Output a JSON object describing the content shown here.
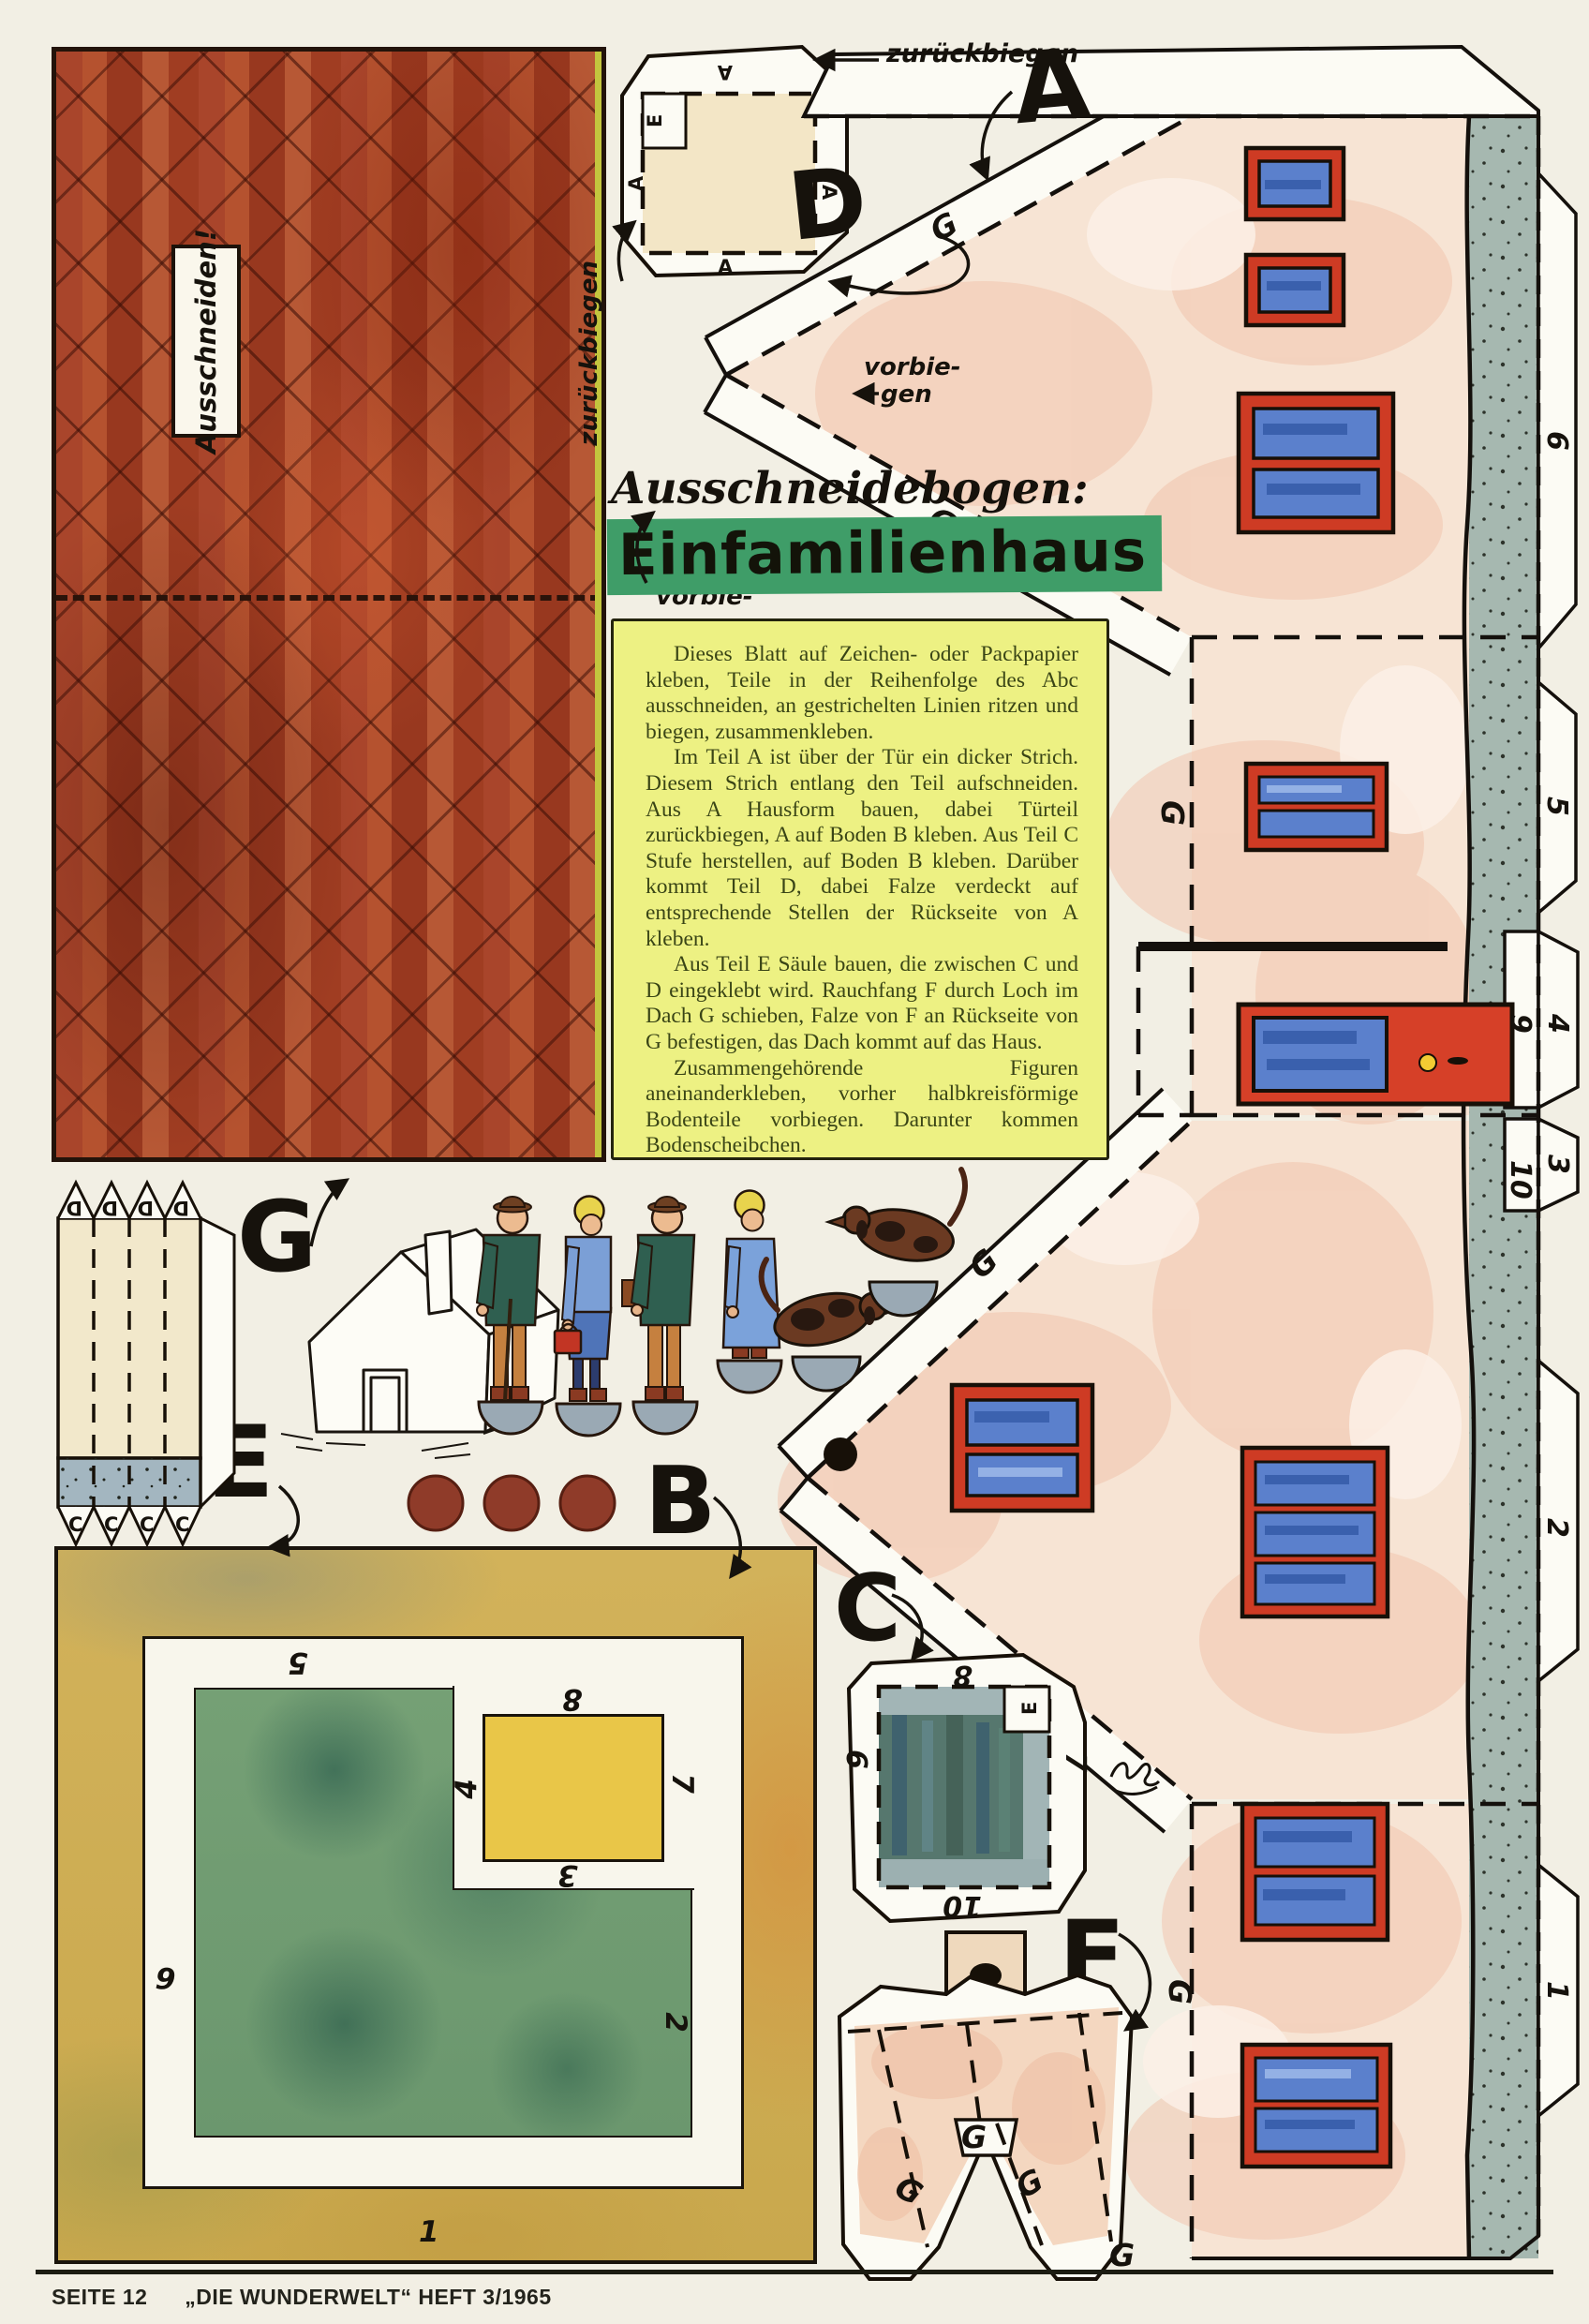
{
  "page": {
    "footer_left": "SEITE 12",
    "footer_right": "„DIE WUNDERWELT“ HEFT 3/1965"
  },
  "title": {
    "script": "Ausschneidebogen:",
    "main": "Einfamilienhaus"
  },
  "roof": {
    "cut_label": "Ausschneiden!"
  },
  "instructions": {
    "p1": "Dieses Blatt auf Zeichen- oder Packpapier kleben, Teile in der Reihenfolge des Abc ausschneiden, an gestrichelten Linien ritzen und biegen, zusammenkleben.",
    "p2": "Im Teil A ist über der Tür ein dicker Strich. Diesem Strich entlang den Teil aufschneiden. Aus A Hausform bauen, dabei Türteil zurückbiegen, A auf Boden B kleben. Aus Teil C Stufe herstellen, auf Boden B kleben. Darüber kommt Teil D, dabei Falze verdeckt auf entsprechende Stellen der Rückseite von A kleben.",
    "p3": "Aus Teil E Säule bauen, die zwischen C und D eingeklebt wird. Rauchfang F durch Loch im Dach G schieben, Falze von F an Rückseite von G befestigen, das Dach kommt auf das Haus.",
    "p4": "Zusammengehörende Figuren aneinanderkleben, vorher halbkreisförmige Bodenteile vorbiegen. Darunter kommen Bodenscheibchen."
  },
  "annotations": {
    "fold_back": "zurückbiegen",
    "fold_back_side": "zurückbiegen",
    "fold_fwd_1": "vorbie-",
    "fold_fwd_2": "gen",
    "fold_hint_1": "vorbie-",
    "fold_hint_2": "gen,",
    "fold_hint_3": "hinter",
    "fold_hint_4": "A kleben."
  },
  "letters": {
    "a": "A",
    "b": "B",
    "c": "C",
    "d": "D",
    "e": "E",
    "f": "F",
    "g": "G"
  },
  "tabs": {
    "t1": "1",
    "t2": "2",
    "t3": "3",
    "t4": "4",
    "t5": "5",
    "t6": "6",
    "t7": "7",
    "t8": "8",
    "t9": "9",
    "t10": "10"
  },
  "colors": {
    "roof_red": "#a9452b",
    "wall_peach": "#f7e4d4",
    "plinth_grey": "#a6b8b0",
    "window_blue": "#5b80cc",
    "frame_red": "#ce3b24",
    "door_red": "#d64028",
    "note_yellow": "#edf183",
    "title_green": "#3f9d68",
    "base_green": "#6b976e",
    "base_ochre": "#c9a84d"
  }
}
